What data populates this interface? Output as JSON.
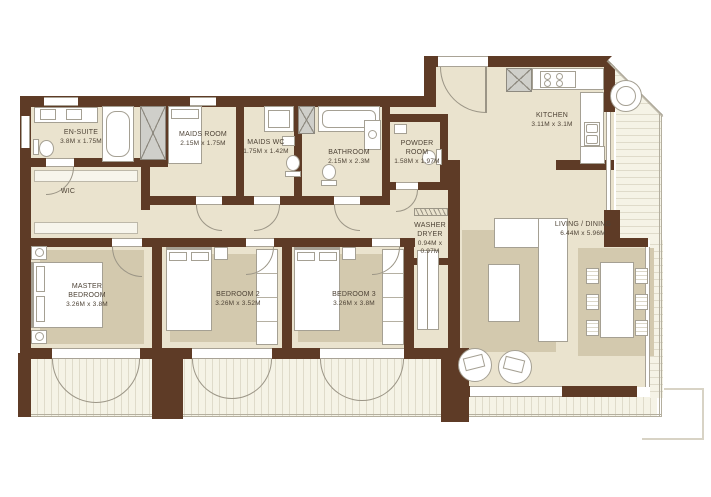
{
  "rooms": {
    "en_suite": {
      "name": "EN-SUITE",
      "dims": "3.8M x 1.75M"
    },
    "wic": {
      "name": "WIC",
      "dims": ""
    },
    "maids_room": {
      "name": "MAIDS ROOM",
      "dims": "2.15M x 1.75M"
    },
    "maids_wc": {
      "name": "MAIDS WC",
      "dims": "1.75M x 1.42M"
    },
    "bathroom": {
      "name": "BATHROOM",
      "dims": "2.15M x 2.3M"
    },
    "powder_room": {
      "name": "POWDER ROOM",
      "dims": "1.58M x 1.97M"
    },
    "kitchen": {
      "name": "KITCHEN",
      "dims": "3.11M x 3.1M"
    },
    "washer_dryer": {
      "name": "WASHER DRYER",
      "dims": "0.94M x 0.97M"
    },
    "master_bedroom": {
      "name": "MASTER BEDROOM",
      "dims": "3.26M x 3.8M"
    },
    "bedroom_2": {
      "name": "BEDROOM 2",
      "dims": "3.26M x 3.52M"
    },
    "bedroom_3": {
      "name": "BEDROOM 3",
      "dims": "3.26M x 3.8M"
    },
    "living_dining": {
      "name": "LIVING / DINING",
      "dims": "6.44M x 5.96M"
    }
  },
  "colors": {
    "wall": "#5e3b26",
    "floor": "#eae3ce",
    "rug": "#d3c9ae",
    "deck": "#f5f3e6",
    "deck_stripe": "#dfdbca",
    "shaft": "#cfcfca",
    "text": "#4e4336"
  }
}
